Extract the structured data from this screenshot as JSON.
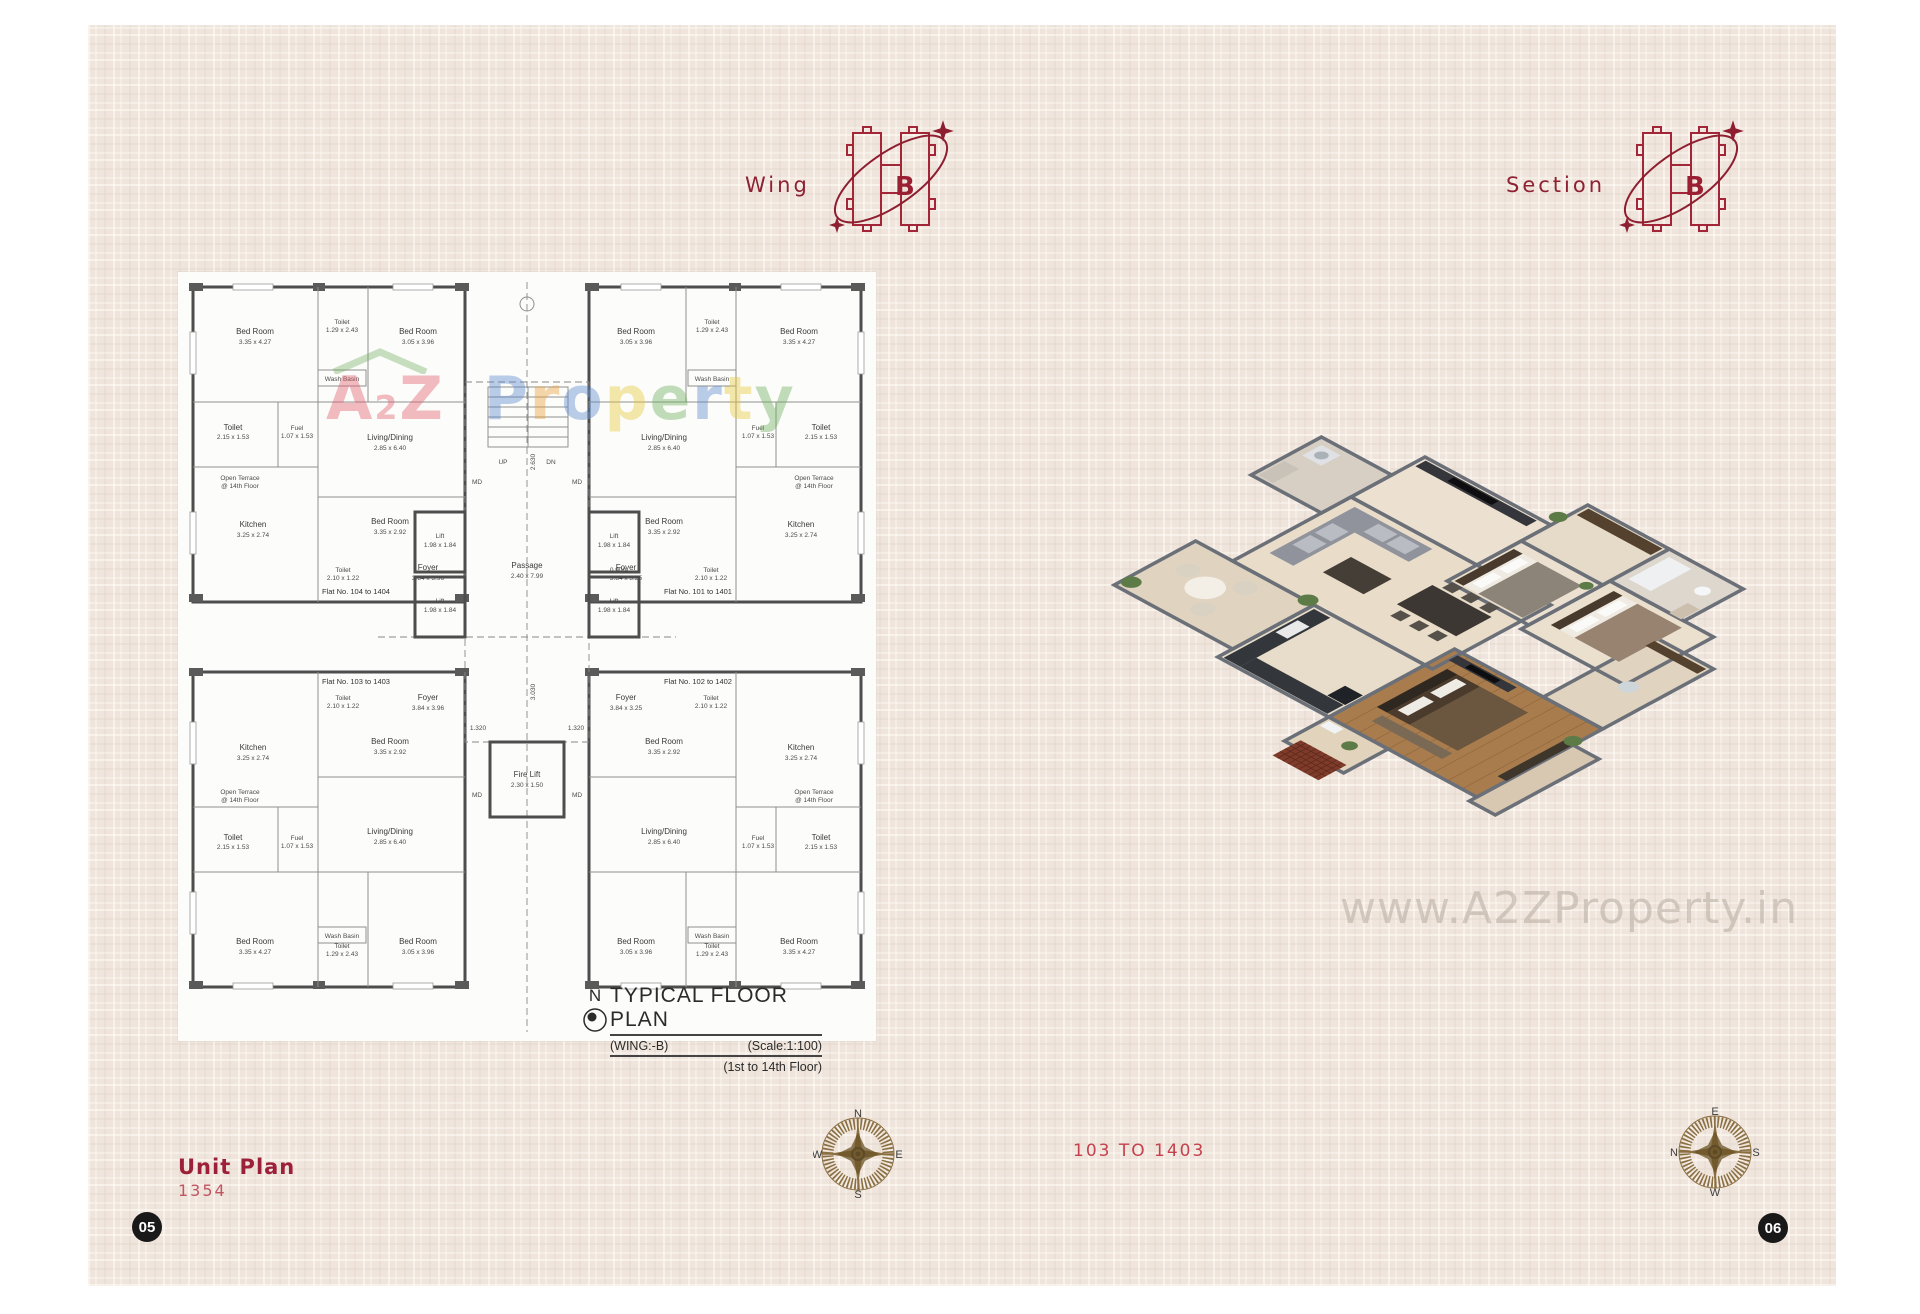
{
  "page": {
    "left_page_number": "05",
    "right_page_number": "06"
  },
  "header": {
    "wing": {
      "label": "Wing",
      "letter": "B"
    },
    "section": {
      "label": "Section",
      "letter": "B"
    }
  },
  "floor_plan": {
    "title": "TYPICAL FLOOR PLAN",
    "subtitle_left": "(WING:-B)",
    "subtitle_right": "(Scale:1:100)",
    "subtitle_floor": "(1st to 14th Floor)",
    "north": "N",
    "flats": [
      "Flat No. 104 to 1404",
      "Flat No. 101 to 1401",
      "Flat No. 103 to 1403",
      "Flat No. 102 to 1402"
    ],
    "rooms": {
      "bedroom_a": {
        "name": "Bed Room",
        "dim": "3.35 x 4.27"
      },
      "bedroom_b": {
        "name": "Bed Room",
        "dim": "3.05 x 3.96"
      },
      "bedroom_c": {
        "name": "Bed Room",
        "dim": "3.35 x 2.92"
      },
      "toilet_a": {
        "name": "Toilet",
        "dim": "2.15 x 1.53"
      },
      "toilet_b": {
        "name": "Toilet",
        "dim": "1.29 x 2.43"
      },
      "toilet_c": {
        "name": "Toilet",
        "dim": "2.10 x 1.22"
      },
      "fuel": {
        "name": "Fuel",
        "dim": "1.07 x 1.53"
      },
      "kitchen": {
        "name": "Kitchen",
        "dim": "3.25 x 2.74"
      },
      "living": {
        "name": "Living/Dining",
        "dim": "2.85 x 6.40"
      },
      "foyer_a": {
        "name": "Foyer",
        "dim": "3.84 x 3.96"
      },
      "foyer_b": {
        "name": "Foyer",
        "dim": "3.84 x 3.25"
      },
      "wash_basin": "Wash Basin",
      "open_terrace_1": "Open Terrace",
      "open_terrace_2": "@ 14th Floor"
    },
    "core": {
      "lift": {
        "name": "Lift",
        "dim": "1.98 x 1.84"
      },
      "fire_lift": {
        "name": "Fire Lift",
        "dim": "2.30 x 1.50"
      },
      "passage": {
        "name": "Passage",
        "dim": "2.40 x 7.99"
      },
      "up": "UP",
      "dn": "DN",
      "md": "MD"
    },
    "dims": {
      "a": "1.320",
      "b": "3.030",
      "c": "0.900",
      "d": "2.630"
    },
    "watermark": {
      "text": "A2Z Property",
      "letters": [
        {
          "ch": "A",
          "color": "#e2606e",
          "small": false
        },
        {
          "ch": "2",
          "color": "#e2606e",
          "small": true
        },
        {
          "ch": "Z",
          "color": "#e2606e",
          "small": false
        },
        {
          "ch": " ",
          "color": "#000000",
          "small": false
        },
        {
          "ch": "P",
          "color": "#5b8bd0",
          "small": false
        },
        {
          "ch": "r",
          "color": "#e8a13c",
          "small": false
        },
        {
          "ch": "o",
          "color": "#5b8bd0",
          "small": false
        },
        {
          "ch": "p",
          "color": "#e8c83c",
          "small": false
        },
        {
          "ch": "e",
          "color": "#6fae5c",
          "small": false
        },
        {
          "ch": "r",
          "color": "#5b8bd0",
          "small": false
        },
        {
          "ch": "t",
          "color": "#e8c83c",
          "small": false
        },
        {
          "ch": "y",
          "color": "#6fae5c",
          "small": false
        }
      ]
    }
  },
  "photo_watermark": "www.A2ZProperty.in",
  "footer": {
    "unit_plan_label": "Unit Plan",
    "unit_plan_number": "1354",
    "flat_range": "103 TO 1403",
    "compass_left": {
      "top": "N",
      "right": "E",
      "bottom": "S",
      "left": "W"
    },
    "compass_right": {
      "top": "E",
      "right": "S",
      "bottom": "W",
      "left": "N"
    }
  },
  "colors": {
    "page_bg": "#efe5dc",
    "accent_red": "#9b1f33",
    "light_red": "#c25562",
    "flat_range_red": "#c5414d",
    "compass_brown": "#8a6f42",
    "page_circle": "#191919",
    "wood_floor": "#a97c4e",
    "iso_wall": "#6b7078"
  }
}
